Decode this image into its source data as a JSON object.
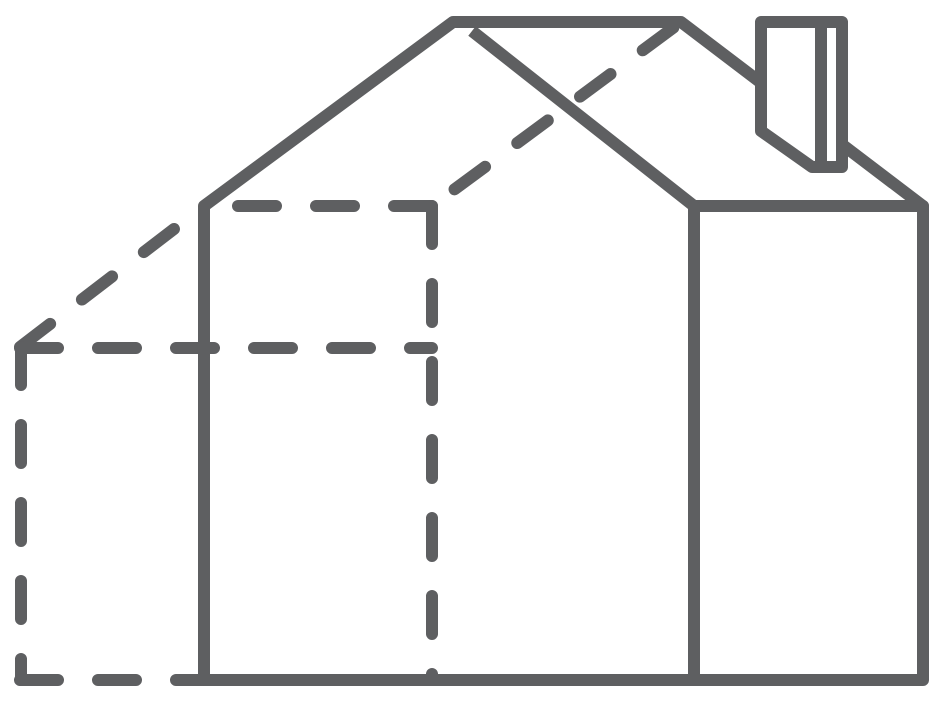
{
  "canvas": {
    "width": 948,
    "height": 706,
    "background": "#ffffff"
  },
  "drawing": {
    "subject": "3d-house-outline-with-hidden-edges",
    "stroke_color": "#5e5f61",
    "stroke_width": 12,
    "dash_pattern": [
      38,
      40
    ],
    "solid_paths": [
      {
        "name": "house-silhouette-outline",
        "d": "M204,680 L204,206 L453,22 L681,22 L923,206 L923,680 Z",
        "fill": "none",
        "linecap": "round"
      },
      {
        "name": "side-wall-top-edge",
        "d": "M694,206 L923,206",
        "fill": "none",
        "linecap": "round"
      },
      {
        "name": "front-gable-right-slope-and-wall-edge",
        "d": "M472,31 L694,206 L694,680",
        "fill": "none",
        "linecap": "butt"
      },
      {
        "name": "chimney-body",
        "d": "M761,131 L761,22 L842,22 L842,167 L812,167 Z",
        "fill": "#ffffff",
        "linecap": "round"
      },
      {
        "name": "chimney-front-corner-edge",
        "d": "M821,24 L821,165",
        "fill": "none",
        "linecap": "butt"
      }
    ],
    "dashed_lines": [
      {
        "name": "hidden-left-eave-diagonal-edge",
        "d": "M20,347 L204,206",
        "dashoffset": 0
      },
      {
        "name": "hidden-back-left-vertical-edge",
        "d": "M21,347 L21,680",
        "dashoffset": 0
      },
      {
        "name": "hidden-back-bottom-edge",
        "d": "M20,680 L204,680",
        "dashoffset": 0
      },
      {
        "name": "hidden-left-wall-top-edge",
        "d": "M432,206 L204,206",
        "dashoffset": 0
      },
      {
        "name": "hidden-interior-vertical-edge",
        "d": "M432,206 L432,680",
        "dashoffset": 0
      },
      {
        "name": "hidden-back-roof-slope-edge",
        "d": "M432,206 L681,22",
        "dashoffset": 50
      },
      {
        "name": "hidden-mid-horizontal-edge",
        "d": "M20,348 L432,348",
        "dashoffset": 0
      }
    ]
  }
}
